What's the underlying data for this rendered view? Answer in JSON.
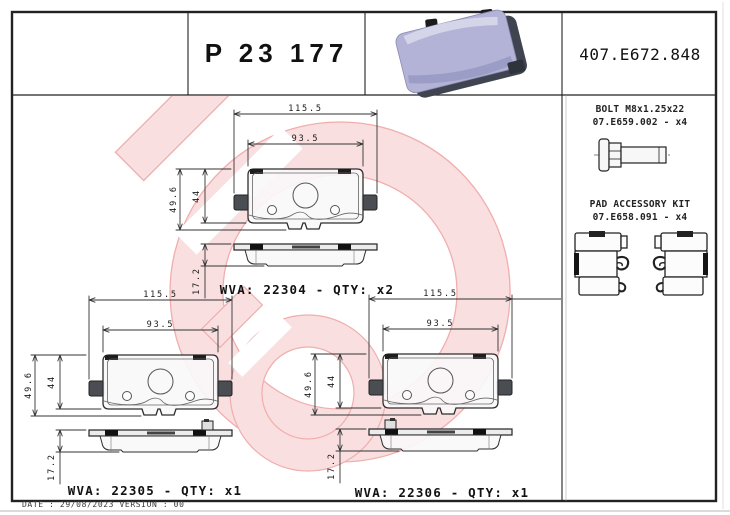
{
  "header": {
    "part_number": "P 23 177",
    "reference": "407.E672.848"
  },
  "right_panel": {
    "bolt_title": "BOLT M8x1.25x22",
    "bolt_ref": "07.E659.002 - x4",
    "kit_title": "PAD ACCESSORY KIT",
    "kit_ref": "07.E658.091 - x4"
  },
  "drawings": {
    "dims": {
      "width": "115.5",
      "pad_width": "93.5",
      "height": "49.6",
      "pad_height": "44",
      "thickness": "17.2"
    },
    "units": "mm"
  },
  "pads": [
    {
      "wva": "22304",
      "qty": "x2",
      "label": "WVA: 22304 - QTY: x2"
    },
    {
      "wva": "22305",
      "qty": "x1",
      "label": "WVA: 22305 - QTY: x1"
    },
    {
      "wva": "22306",
      "qty": "x1",
      "label": "WVA: 22306 - QTY: x1"
    }
  ],
  "footer": {
    "text": "DATE : 29/08/2023 VERSION : 00"
  },
  "branding": {
    "watermark_icon": "brembo-logo-watermark",
    "colors": {
      "watermark_band": "#f9dcdc",
      "watermark_line": "#efa6a6",
      "pad_photo_lavender": "#b2b3d6",
      "drawing_line": "#2a2a2a"
    }
  }
}
